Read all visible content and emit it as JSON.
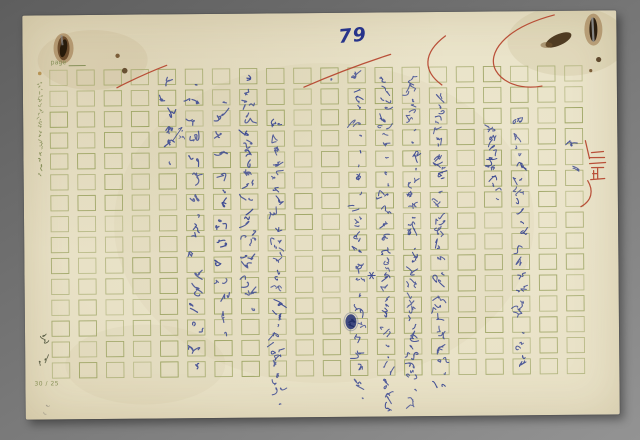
{
  "scan": {
    "page_number": "79",
    "paper_type_label": "page",
    "grid_spec_label": "30 / 25",
    "red_annotation": "三正",
    "side_mark_text": "文藝",
    "colors": {
      "background_gray": "#757575",
      "paper": "#e8e1c6",
      "grid_line": "#99a15f",
      "ink_blue": "#3e4b93",
      "page_number_blue": "#27348b",
      "red_pen": "#b5432c",
      "rust_brown": "#5a3a1c",
      "print_green": "#87915a"
    },
    "grid": {
      "columns": 20,
      "rows": 15,
      "x0": 27,
      "y0": 55,
      "col_pitch": 27.1,
      "row_pitch": 20.9,
      "cell_w": 17.4,
      "cell_h": 15.2
    },
    "margin_print": {
      "legibility": "illegible-small-print",
      "glyphs": 22,
      "x": 15,
      "y": 66,
      "size": 4.4,
      "pitch": 4.3,
      "color": "#79854b"
    },
    "side_mark": {
      "x": 13,
      "y": 318,
      "glyphs": 2,
      "size": 9,
      "pitch": 22,
      "color": "#4d5138"
    },
    "pencil_marks": {
      "x": 17,
      "y": 388,
      "glyphs": 2,
      "size": 6,
      "pitch": 7,
      "color": "#9a9383"
    },
    "handwriting": {
      "ink": "blue ballpoint",
      "transcription_confidence": "low (draft cursive, partly illegible)",
      "runs": [
        {
          "col": 5,
          "x": 144,
          "y": 61,
          "size": 13,
          "pitch": 16,
          "text": "上扰手扰长、"
        },
        {
          "col": 5,
          "x": 158,
          "y": 113,
          "size": 6,
          "pitch": 7,
          "text": "✓咻",
          "note": "interlinear-insertion"
        },
        {
          "col": 6,
          "x": 171,
          "y": 61,
          "size": 13,
          "pitch": 19,
          "text": "「玉国人狂改爱，白天扰手扰过她地"
        },
        {
          "col": 7,
          "x": 198,
          "y": 79,
          "size": 13,
          "pitch": 18,
          "text": "「复公美别，钉似在一中中间，"
        },
        {
          "col": 8,
          "x": 225,
          "y": 59,
          "size": 13,
          "pitch": 13.5,
          "text": "觉得美国人与法国人最大公差别是古么。"
        },
        {
          "col": 9,
          "x": 252,
          "y": 107,
          "size": 12,
          "pitch": 12.5,
          "text": "一个法国人在美国待了相当长的时间，有人问到他，"
        },
        {
          "col": 11,
          "x": 307,
          "y": 59,
          "size": 11,
          "pitch": 14,
          "text": "、"
        },
        {
          "col": 12,
          "x": 334,
          "y": 59,
          "size": 12,
          "pitch": 14.5,
          "text": "捕回老连：「（益）面我钓俐克了，是上半情的酒，"
        },
        {
          "col": 13,
          "x": 361,
          "y": 59,
          "size": 12,
          "pitch": 13.3,
          "text": "到又处我例光，」「作心看法我见可不数芳同，、与一个水"
        },
        {
          "col": 14,
          "x": 388,
          "y": 59,
          "size": 12,
          "pitch": 13,
          "text": "们水捕鱼：「了」有古全用呢，人盆一面地的把我洗涮，之"
        },
        {
          "col": 15,
          "x": 415,
          "y": 83,
          "size": 12,
          "pitch": 13,
          "text": "有一则故事提到：一个水井强，真西们水桶法活，一"
        },
        {
          "col": 17,
          "x": 469,
          "y": 111,
          "size": 11,
          "pitch": 10,
          "text": "要到的见上去了。"
        },
        {
          "col": 18,
          "x": 496,
          "y": 105,
          "size": 12,
          "pitch": 14,
          "text": "十看活全在於作，一笑亮上候便是、圣女"
        },
        {
          "col": 20,
          "x": 551,
          "y": 128,
          "size": 12,
          "pitch": 16,
          "text": "嗅"
        },
        {
          "col": 20,
          "x": 552,
          "y": 154,
          "size": 12,
          "pitch": 16,
          "text": "点"
        }
      ]
    },
    "marks": {
      "blue_asterisk": {
        "x": 347,
        "y": 263
      },
      "ink_blot": {
        "x": 326,
        "y": 309
      },
      "staples": 2,
      "rust_spots": 5
    }
  }
}
